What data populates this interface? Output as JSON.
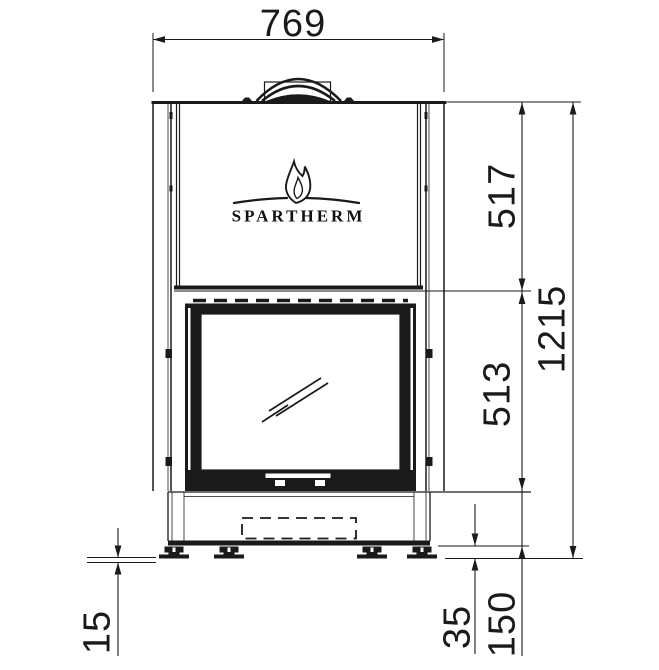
{
  "brand": {
    "logo_text": "SPARTHERM"
  },
  "dimensions": {
    "overall_width": "769",
    "upper_height": "517",
    "firebox_height": "513",
    "total_height": "1215",
    "plinth_height": "150",
    "foot_height": "35",
    "foot_adjustment": "15"
  },
  "colors": {
    "line": "#1a1a1a",
    "background": "#ffffff"
  }
}
